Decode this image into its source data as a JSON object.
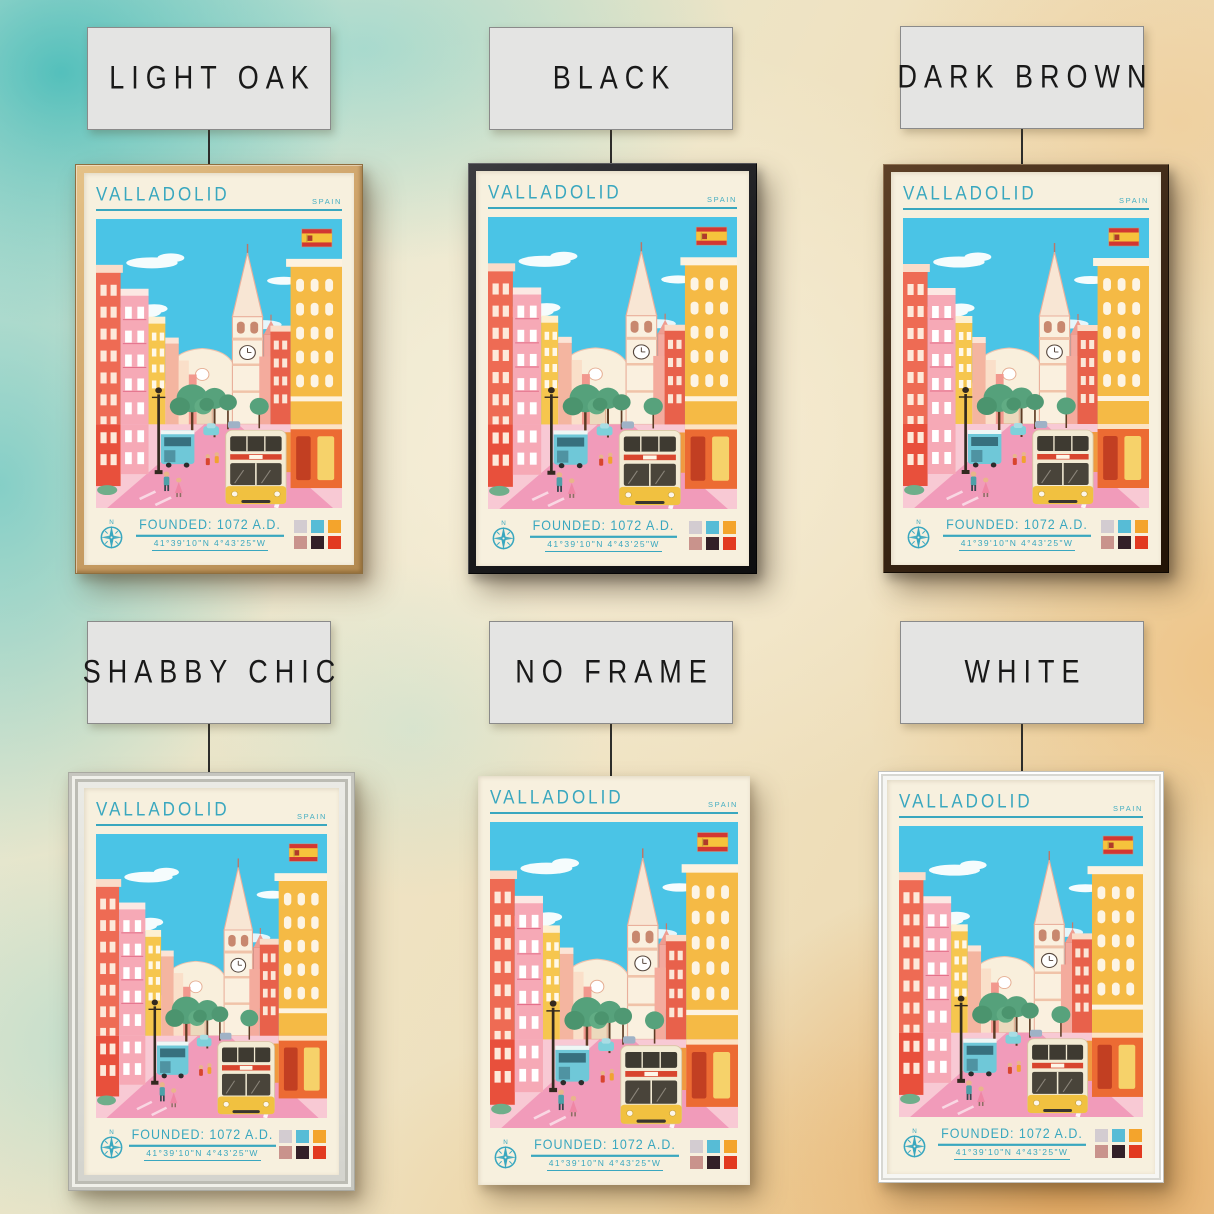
{
  "options": [
    {
      "id": "light-oak",
      "label": "LIGHT OAK",
      "frame_color": "#c9a268"
    },
    {
      "id": "black",
      "label": "BLACK",
      "frame_color": "#1d1d20"
    },
    {
      "id": "dark-brown",
      "label": "DARK BROWN",
      "frame_color": "#3a2817"
    },
    {
      "id": "shabby-chic",
      "label": "SHABBY CHIC",
      "frame_color": "#dcdcd6"
    },
    {
      "id": "no-frame",
      "label": "NO FRAME",
      "frame_color": null
    },
    {
      "id": "white",
      "label": "WHITE",
      "frame_color": "#f5f5f2"
    }
  ],
  "poster": {
    "city": "VALLADOLID",
    "country": "SPAIN",
    "founded": "FOUNDED: 1072 A.D.",
    "coordinates": "41°39'10\"N 4°43'25\"W",
    "flag_icon": "spain-flag-icon",
    "compass_icon": "compass-rose-icon",
    "palette": [
      "#d3ccd1",
      "#57bcd6",
      "#f4a42c",
      "#c9938c",
      "#332028",
      "#e23a20"
    ]
  },
  "colors": {
    "poster_accent": "#39a7bf",
    "poster_paper": "#f7f0de",
    "sky": "#4ac4e6",
    "road": "#f19bba",
    "wall_teal": "#7fccc8",
    "wall_orange": "#e8a75e"
  }
}
